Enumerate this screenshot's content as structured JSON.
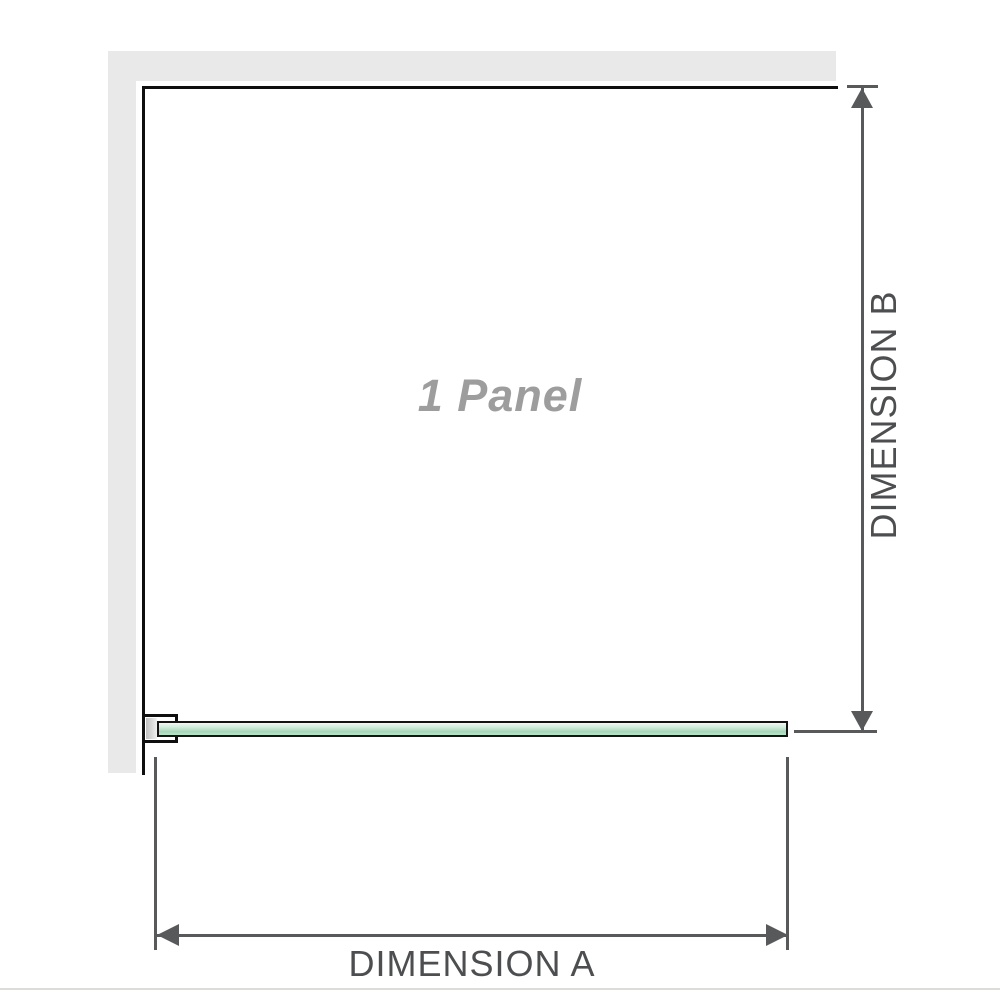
{
  "diagram": {
    "panel_label": "1 Panel",
    "dimension_a": {
      "label": "DIMENSION A"
    },
    "dimension_b": {
      "label": "DIMENSION B"
    }
  },
  "colors": {
    "background": "#ffffff",
    "wall": "#e9e9e9",
    "outline": "#0f0f0f",
    "glass_border": "#141414",
    "glass_top": "#f2faf4",
    "glass_mid": "#cdebd8",
    "glass_deep": "#a5d7b8",
    "glass_bottom": "#bde3c9",
    "bracket_insert_dark": "#bfbfbf",
    "bracket_insert_light": "#f1f1f1",
    "dimension_line": "#58595b",
    "dimension_text": "#4d4e50",
    "panel_label_text": "#9d9d9d",
    "bottom_rule": "#dcdcd8"
  }
}
